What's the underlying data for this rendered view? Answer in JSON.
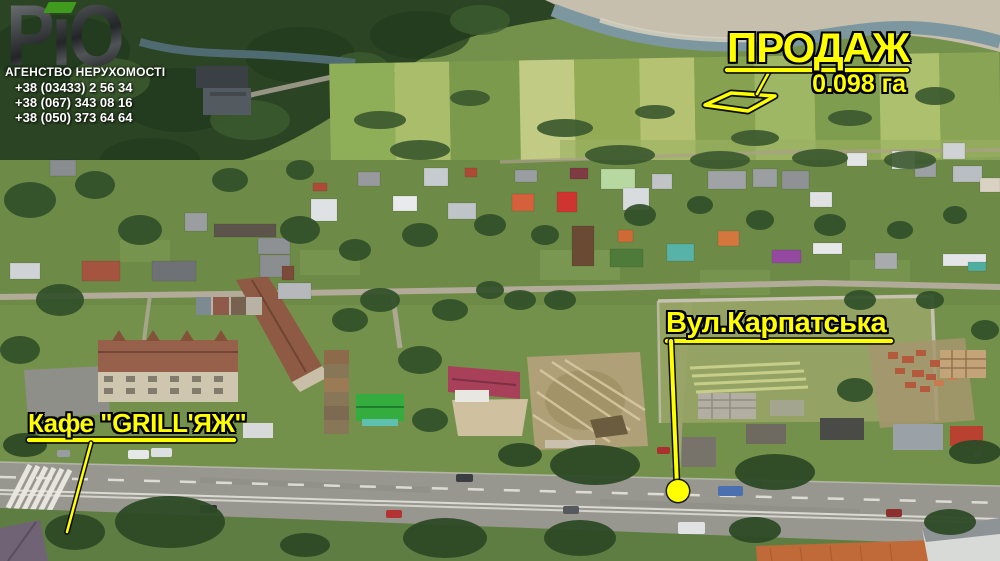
{
  "branding": {
    "logo_text": "РіО",
    "agency_name": "АГЕНСТВО НЕРУХОМОСТІ",
    "phones": [
      "+38 (03433) 2 56 34",
      "+38 (067) 343 08 16",
      "+38 (050) 373 64 64"
    ]
  },
  "annotations": {
    "sale_label": "ПРОДАЖ",
    "sale_area": "0.098 га",
    "street_label": "Вул.Карпатська",
    "cafe_label": "Кафе \"GRILL'ЯЖ\"",
    "accent_color": "#ffff00",
    "outline_color": "#000000",
    "logo_dot_color": "#3f9a1d"
  }
}
